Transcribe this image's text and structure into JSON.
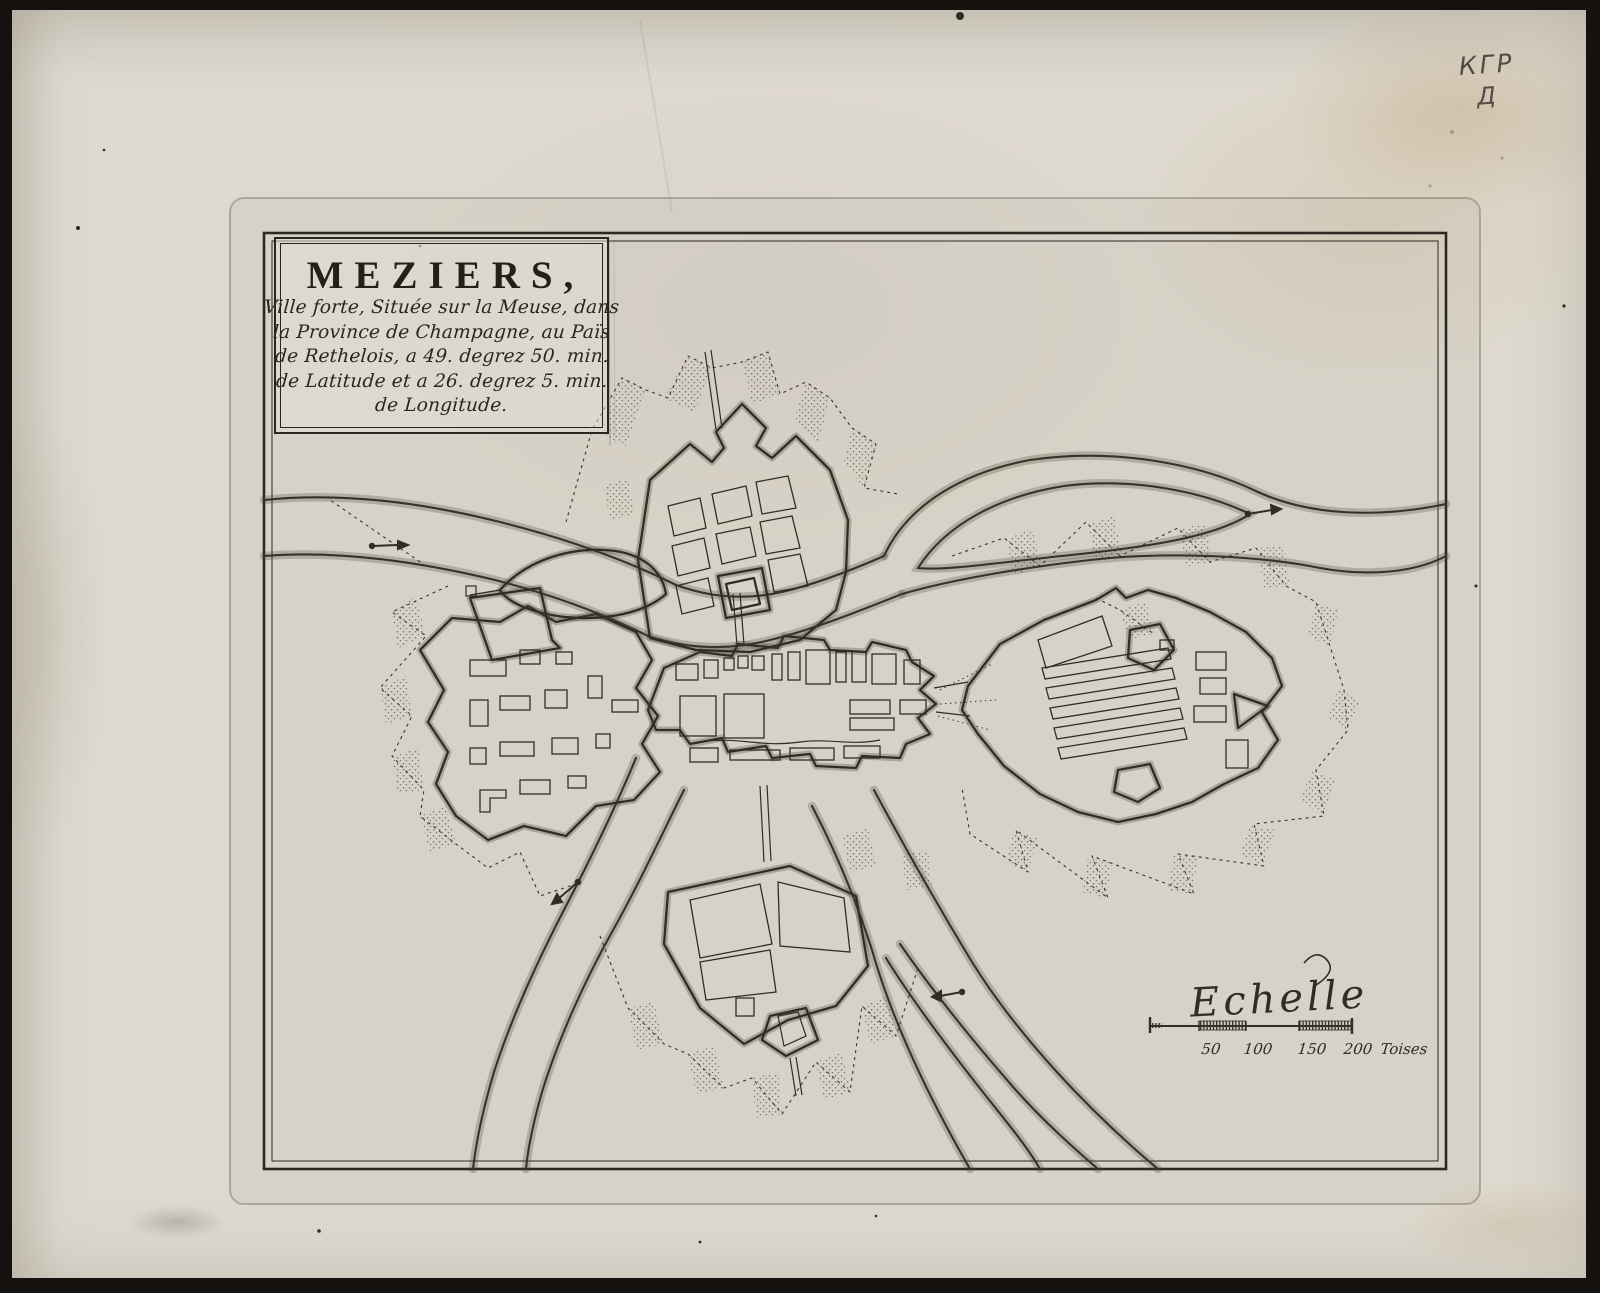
{
  "artifact": {
    "handwritten_mark_line1": "КГР",
    "handwritten_mark_line2": "Д"
  },
  "cartouche": {
    "title": "MEZIERS,",
    "description_lines": [
      "Ville forte, Située sur la Meuse, dans",
      "la Province de Champagne, au Païs",
      "de Rethelois, a 49. degrez 50. min.",
      "de Latitude et a 26. degrez 5. min.",
      "de Longitude."
    ]
  },
  "scale_bar": {
    "label": "Echelle",
    "ticks": [
      "50",
      "100",
      "150",
      "200"
    ],
    "unit": "Toises"
  },
  "colors": {
    "paper": "#ded9cf",
    "ink": "#2f2922",
    "stain": "#b99a6b",
    "pencil": "#514c44",
    "scan_background": "#14110e"
  }
}
